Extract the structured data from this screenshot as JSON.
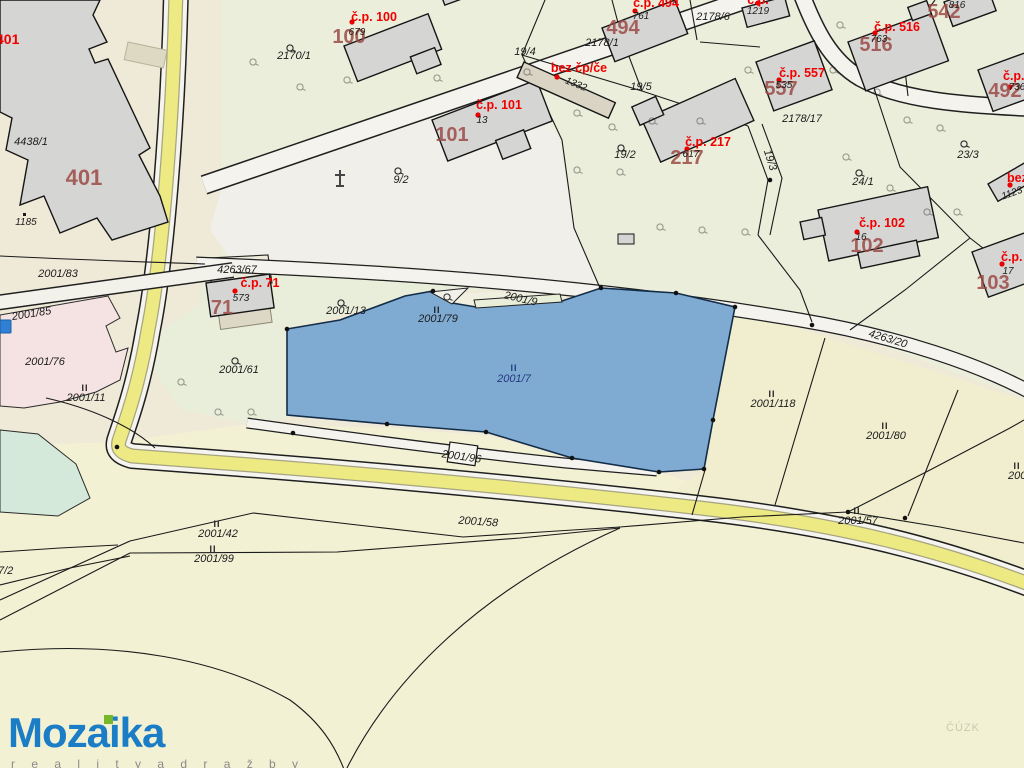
{
  "logo": {
    "title": "Mozaika",
    "tagline": "r e a l i t y   a   d r a ž b y"
  },
  "watermark": "ČÚZK",
  "symbols": {
    "landuse": "II"
  },
  "colors": {
    "highlight_parcel": "#7fabd3",
    "red_label": "#f20000",
    "building_number": "#9c4a46",
    "logo_blue": "#1a7dc5",
    "logo_green": "#76b82a",
    "road_yellow": "#edea83"
  },
  "labels": {
    "red": {
      "cp401": "č.p. 401",
      "cp100": "č.p. 100",
      "cp101": "č.p. 101",
      "bez1": "bez čp/če",
      "cp494": "č.p. 494",
      "cp516": "č.p. 516",
      "cp557": "č.p. 557",
      "cp217": "č.p. 217",
      "cp102": "č.p. 102",
      "cp71": "č.p. 71",
      "cp103": "č.p.",
      "cp492": "č.p.",
      "bez2": "bez čp/če",
      "cpTop": "č.p."
    },
    "buildingNumbers": {
      "n401": "401",
      "n100": "100",
      "n101": "101",
      "n494": "494",
      "n542": "542",
      "n516": "516",
      "n557": "557",
      "n217": "217",
      "n102": "102",
      "n71": "71",
      "n103": "103",
      "n492": "492"
    },
    "houseNumbers": {
      "h679": "679",
      "h13": "13",
      "h1332": "1332",
      "h761": "761",
      "h1219": "1219",
      "h816": "816",
      "h763": "763",
      "h535": "535",
      "h617": "617",
      "h16": "16",
      "h573": "573",
      "h736": "736",
      "h17": "17",
      "h1123": "1123",
      "h1185": "1185"
    },
    "parcels": {
      "p2170_1": "2170/1",
      "p9_2": "9/2",
      "p4438_1": "4438/1",
      "p2001_83": "2001/83",
      "p2001_85": "2001/85",
      "p2001_76": "2001/76",
      "p2001_11": "2001/11",
      "p2001_61": "2001/61",
      "p2001_13": "2001/13",
      "p2001_79": "2001/79",
      "p2001_7": "2001/7",
      "p2001_9": "2001/9",
      "p2001_118": "2001/118",
      "p2001_80": "2001/80",
      "p4263_20": "4263/20",
      "p4263_67": "4263/67",
      "p2001_57": "2001/57",
      "p2001_42": "2001/42",
      "p2001_99": "2001/99",
      "p2001_58": "2001/58",
      "p2001_96": "2001/96",
      "p7_2": "7/2",
      "p19_4": "19/4",
      "p19_5": "19/5",
      "p19_2": "19/2",
      "p19_3": "19/3",
      "p23_3": "23/3",
      "p24_1": "24/1",
      "p2178_1": "2178/1",
      "p2178_6": "2178/6",
      "p2178_17": "2178/17",
      "p2001_edge": "2001"
    }
  }
}
